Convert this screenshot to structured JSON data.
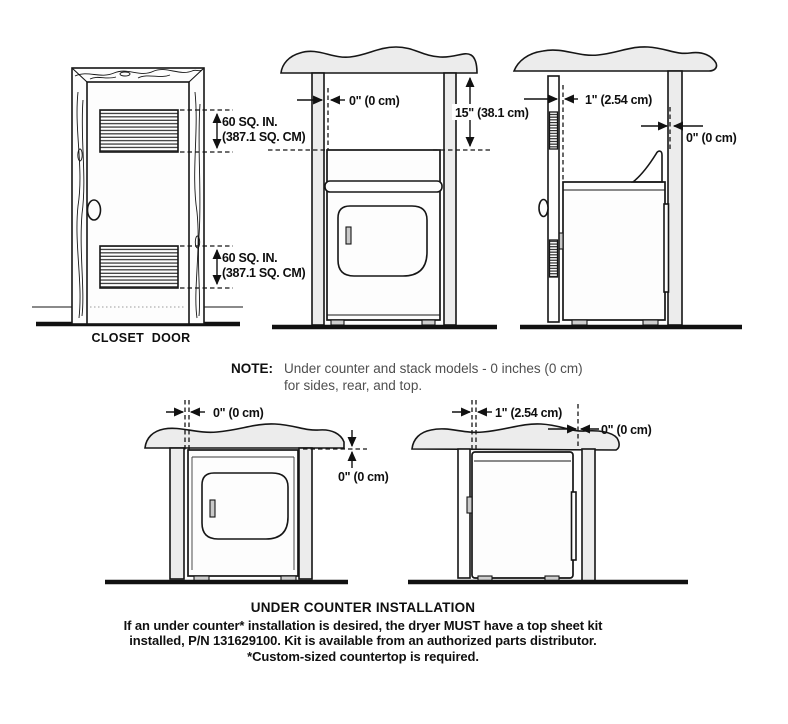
{
  "colors": {
    "ink": "#161616",
    "panel_gray": "#ececec",
    "note_text": "#4f4f4f"
  },
  "closet_front": {
    "caption": "CLOSET DOOR",
    "top_vent_line1": "60 SQ. IN.",
    "top_vent_line2": "(387.1 SQ. CM)",
    "bottom_vent_line1": "60 SQ. IN.",
    "bottom_vent_line2": "(387.1 SQ. CM)"
  },
  "alcove_front": {
    "side_clearance": "0\" (0 cm)",
    "top_clearance": "15\" (38.1 cm)"
  },
  "closet_side": {
    "door_clearance": "1\" (2.54 cm)",
    "rear_clearance": "0\" (0 cm)"
  },
  "note": {
    "label": "NOTE:",
    "line1": "Under counter and stack models - 0 inches (0 cm)",
    "line2": "for sides, rear, and top."
  },
  "under_counter_front": {
    "side_clearance": "0\" (0 cm)",
    "top_clearance": "0\" (0 cm)"
  },
  "under_counter_side": {
    "door_clearance": "1\" (2.54 cm)",
    "rear_clearance": "0\" (0 cm)"
  },
  "footer": {
    "title": "UNDER COUNTER INSTALLATION",
    "line1": "If an under counter* installation is desired, the dryer MUST have a top sheet kit",
    "line2": "installed, P/N 131629100. Kit is available from an authorized parts distributor.",
    "line3": "*Custom-sized countertop is required."
  }
}
